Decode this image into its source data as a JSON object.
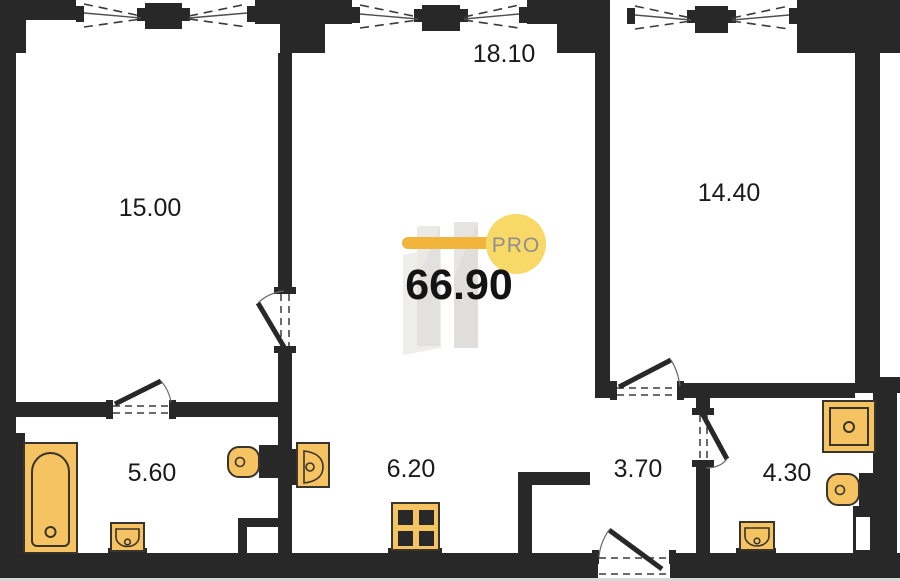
{
  "floorplan": {
    "total_area": "66.90",
    "logo_text": "PRO",
    "rooms": [
      {
        "id": "room-top-left",
        "area": "15.00"
      },
      {
        "id": "room-top-middle",
        "area": "18.10"
      },
      {
        "id": "room-top-right",
        "area": "14.40"
      },
      {
        "id": "bathroom-left",
        "area": "5.60"
      },
      {
        "id": "hallway-middle",
        "area": "6.20"
      },
      {
        "id": "hall-right",
        "area": "3.70"
      },
      {
        "id": "bathroom-right",
        "area": "4.30"
      }
    ],
    "fixtures": [
      {
        "room_area": "5.60",
        "type": "bathtub"
      },
      {
        "room_area": "5.60",
        "type": "washbasin"
      },
      {
        "room_area": "5.60",
        "type": "toilet"
      },
      {
        "room_area": "6.20",
        "type": "washbasin"
      },
      {
        "room_area": "6.20",
        "type": "stove"
      },
      {
        "room_area": "4.30",
        "type": "shower"
      },
      {
        "room_area": "4.30",
        "type": "toilet"
      },
      {
        "room_area": "4.30",
        "type": "washbasin"
      }
    ],
    "colors": {
      "wall": "#282828",
      "fixture-fill": "#F5C361",
      "fixture-stroke": "#39342C",
      "accent-bar": "#F2B53B",
      "accent-circle": "#F8D867",
      "logo-text": "#8F8F8F",
      "label": "#1A1A1A",
      "watermark": "#C8C5C0"
    }
  }
}
